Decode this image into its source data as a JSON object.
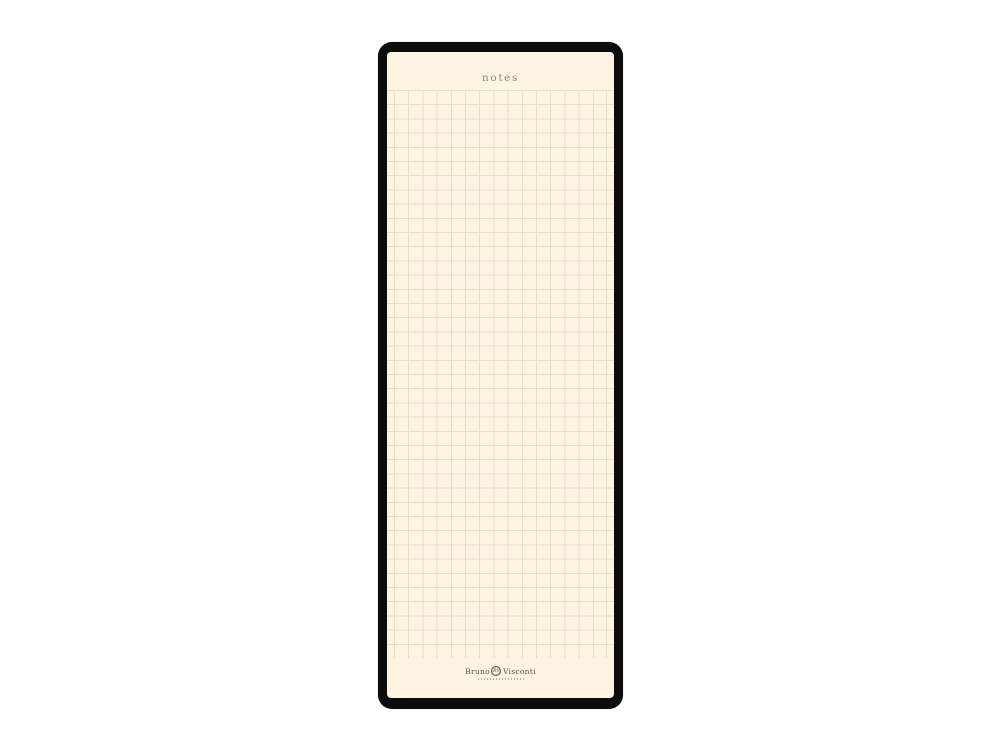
{
  "page": {
    "title": "notes"
  },
  "brand": {
    "first": "Bruno",
    "second": "Visconti",
    "monogram": "BV"
  },
  "colors": {
    "canvas_bg": "#ffffff",
    "frame": "#0c0c0c",
    "page_bg": "#fdf5e2",
    "grid_line": "#e8dfc9",
    "grid_line_soft": "#efe7d4",
    "title": "#8e887b",
    "brand": "#564f45"
  }
}
